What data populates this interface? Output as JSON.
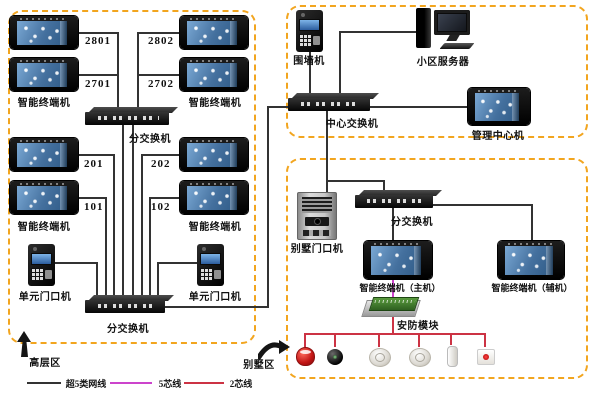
{
  "zones": {
    "highrise": "高层区",
    "villa": "别墅区"
  },
  "highrise": {
    "terminal_label": "智能终端机",
    "rooms": [
      "2801",
      "2802",
      "2701",
      "2702",
      "201",
      "202",
      "101",
      "102"
    ],
    "switch_label": "分交换机",
    "unit_door_label": "单元门口机"
  },
  "center": {
    "wall_machine": "围墙机",
    "server": "小区服务器",
    "switch": "中心交换机",
    "mgmt_terminal": "管理中心机"
  },
  "villa": {
    "door": "别墅门口机",
    "switch_label": "分交换机",
    "main_terminal": "智能终端机（主机）",
    "aux_terminal": "智能终端机（辅机）",
    "security_module": "安防模块"
  },
  "legend": {
    "items": [
      {
        "label": "超5类网线",
        "color": "#3c3c3c"
      },
      {
        "label": "5芯线",
        "color": "#cc44cc"
      },
      {
        "label": "2芯线",
        "color": "#cc3344"
      }
    ]
  }
}
